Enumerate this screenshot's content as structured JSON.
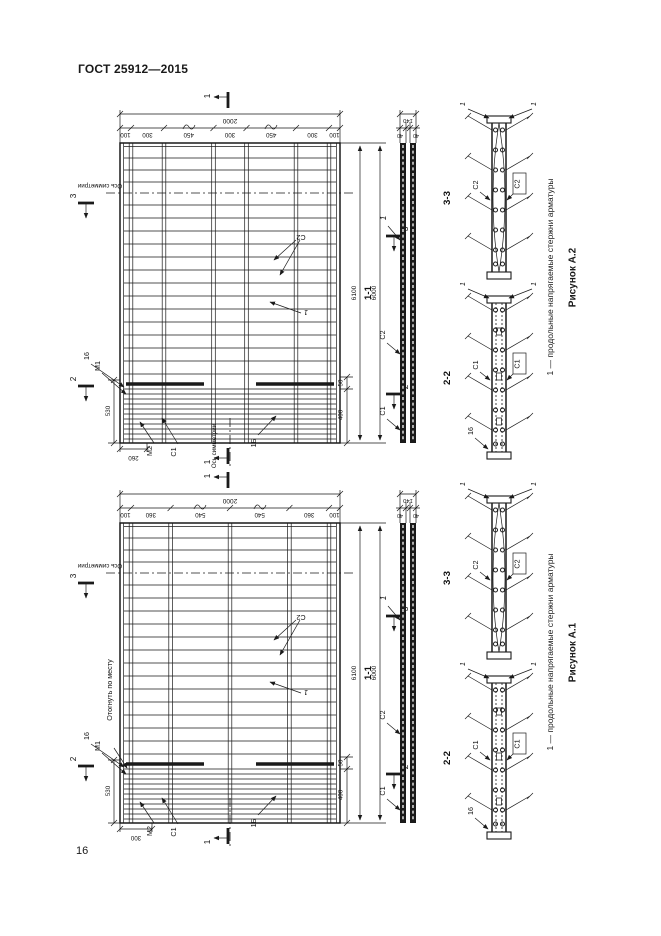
{
  "page": {
    "header": "ГОСТ 25912—2015",
    "number": "16"
  },
  "figures": [
    {
      "caption": "Рисунок А.2",
      "note": "1 — продольные напрягаемые стержни арматуры",
      "plan": {
        "dim_total": "2000",
        "chain": [
          "100",
          "300",
          "450",
          "300",
          "450",
          "300",
          "100"
        ],
        "dim_bar_length": "6100",
        "dim_slab_length": "6000",
        "dim_530": "530",
        "dim_bottom": "260",
        "dim_400": "400",
        "dim_50": "50",
        "axis_h": "Ось симметрии",
        "axis_v": "Ось симметрии",
        "mark_c1": "С1",
        "mark_c2": "С2",
        "mark_m1": "М1",
        "mark_m2": "М2",
        "mark_16": "16",
        "mark_1b": "1Б",
        "mark_1": "1",
        "flag_1": "1",
        "flag_2": "2",
        "flag_3": "3"
      },
      "sec11": {
        "title": "1-1",
        "dim_140": "140",
        "dim_40a": "40",
        "dim_40b": "40",
        "mark_1": "1",
        "mark_c2": "С2",
        "mark_c1": "С1"
      },
      "sec33": {
        "title": "3-3",
        "mark_left": "С2",
        "mark_right": "С2",
        "mark_1": "1"
      },
      "sec22": {
        "title": "2-2",
        "mark_left": "С1",
        "mark_right": "С1",
        "mark_16": "16",
        "mark_1": "1"
      }
    },
    {
      "caption": "Рисунок А.1",
      "note": "1 — продольные напрягаемые стержни арматуры",
      "plan": {
        "dim_total": "2000",
        "chain": [
          "100",
          "360",
          "540",
          "540",
          "360",
          "100"
        ],
        "dim_bar_length": "6100",
        "dim_slab_length": "6000",
        "dim_530": "530",
        "dim_bottom": "300",
        "dim_400": "400",
        "dim_50": "50",
        "axis_h": "Ось симметрии",
        "bend_note": "Отогнуть по месту",
        "mark_c1": "С1",
        "mark_c2": "С2",
        "mark_m1": "М1",
        "mark_m2": "М2",
        "mark_16": "16",
        "mark_1b": "1Б",
        "mark_1": "1",
        "flag_1": "1",
        "flag_2": "2",
        "flag_3": "3"
      },
      "sec11": {
        "title": "1-1",
        "dim_140": "140",
        "dim_40a": "40",
        "dim_40b": "40",
        "mark_1": "1",
        "mark_c2": "С2",
        "mark_c1": "С1"
      },
      "sec33": {
        "title": "3-3",
        "mark_left": "С2",
        "mark_right": "С2",
        "mark_1": "1"
      },
      "sec22": {
        "title": "2-2",
        "mark_left": "С1",
        "mark_right": "С1",
        "mark_16": "16",
        "mark_1": "1"
      }
    }
  ]
}
